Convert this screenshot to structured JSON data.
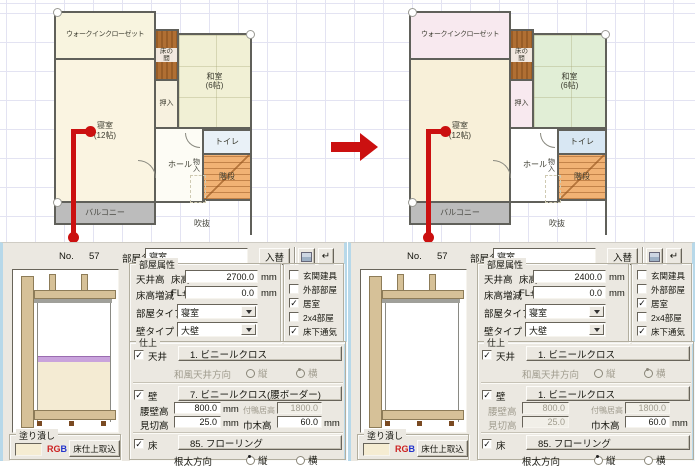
{
  "units": {
    "mm": "mm"
  },
  "icons": {
    "return": "↵"
  },
  "annotation": {
    "arrow_color": "#cb1010",
    "line_color": "#cb1010"
  },
  "plans": [
    {
      "rooms": {
        "walkin": "ウォークインクローゼット",
        "tokonoma": "床の間",
        "washitsu": "和室",
        "washitsu_size": "(6帖)",
        "oshiire": "押入",
        "bedroom": "寝室",
        "bedroom_size": "(12帖)",
        "toilet": "トイレ",
        "hall": "ホール",
        "monoire": "物入",
        "stairs": "階段",
        "balcony": "バルコニー",
        "void": "吹抜"
      },
      "room_colors": {
        "walkin": "#f8f4df",
        "tokonoma": "#b06f33",
        "washitsu": "#f1f0d5",
        "oshiire": "#f7f1df",
        "bedroom": "#faf4e1",
        "toilet": "#e9f1f7",
        "hall": "#fdfcf5",
        "stairs": "#f1b274",
        "balcony": "#bcbcbc"
      }
    },
    {
      "rooms": {
        "walkin": "ウォークインクローゼット",
        "tokonoma": "床の間",
        "washitsu": "和室",
        "washitsu_size": "(6帖)",
        "oshiire": "押入",
        "bedroom": "寝室",
        "bedroom_size": "(12帖)",
        "toilet": "トイレ",
        "hall": "ホール",
        "monoire": "物入",
        "stairs": "階段",
        "balcony": "バルコニー",
        "void": "吹抜"
      },
      "room_colors": {
        "walkin": "#f8e9ef",
        "tokonoma": "#b06f33",
        "washitsu": "#e1eed6",
        "oshiire": "#f8e9ef",
        "bedroom": "#f8f0d9",
        "toilet": "#d8e7f3",
        "hall": "#ffffff",
        "stairs": "#f1b274",
        "balcony": "#bcbcbc"
      }
    }
  ],
  "panels": [
    {
      "no_label": "No.",
      "no_value": "57",
      "room_name_label": "部屋名",
      "room_name_value": "寝室",
      "swap_button": "入替",
      "attr": {
        "title": "部屋属性",
        "ceiling_label": "天井高",
        "floor_plus_label": "床高+",
        "ceiling_value": "2700.0",
        "floor_adj_label": "床高増減",
        "fl_label": "FL±",
        "fl_value": "0.0",
        "room_type_label": "部屋タイプ",
        "room_type_value": "寝室",
        "wall_type_label": "壁タイプ",
        "wall_type_value": "大壁"
      },
      "checks": [
        {
          "label": "玄関建具",
          "mark": ""
        },
        {
          "label": "外部部屋",
          "mark": ""
        },
        {
          "label": "居室",
          "mark": "✓"
        },
        {
          "label": "2x4部屋",
          "mark": ""
        },
        {
          "label": "床下通気",
          "mark": "✓"
        }
      ],
      "finish": {
        "title": "仕上",
        "ceiling_label": "天井",
        "ceiling_mark": "✓",
        "ceiling_button": "1. ビニールクロス",
        "wafu_label": "和風天井方向",
        "tate": "縦",
        "yoko": "横",
        "wall_label": "壁",
        "wall_mark": "✓",
        "wall_button": "7. ビニールクロス(腰ボーダー)",
        "koshikabe_label": "腰壁高",
        "koshikabe_value": "800.0",
        "tsukekamoi_label": "付鴨居高",
        "tsukekamoi_value": "1800.0",
        "mikiri_label": "見切高",
        "mikiri_value": "25.0",
        "habaki_label": "巾木高",
        "habaki_value": "60.0",
        "floor_label": "床",
        "floor_mark": "✓",
        "floor_button": "85. フローリング",
        "neda_label": "根太方向"
      },
      "fill": {
        "title": "塗り潰し",
        "rgb_r": "R",
        "rgb_g": "G",
        "rgb_b": "B",
        "import_button": "床仕上取込",
        "swatch_color": "#f5ecd2"
      }
    },
    {
      "no_label": "No.",
      "no_value": "57",
      "room_name_label": "部屋名",
      "room_name_value": "寝室",
      "swap_button": "入替",
      "attr": {
        "title": "部屋属性",
        "ceiling_label": "天井高",
        "floor_plus_label": "床高+",
        "ceiling_value": "2400.0",
        "floor_adj_label": "床高増減",
        "fl_label": "FL±",
        "fl_value": "0.0",
        "room_type_label": "部屋タイプ",
        "room_type_value": "寝室",
        "wall_type_label": "壁タイプ",
        "wall_type_value": "大壁"
      },
      "checks": [
        {
          "label": "玄関建具",
          "mark": ""
        },
        {
          "label": "外部部屋",
          "mark": ""
        },
        {
          "label": "居室",
          "mark": "✓"
        },
        {
          "label": "2x4部屋",
          "mark": ""
        },
        {
          "label": "床下通気",
          "mark": "✓"
        }
      ],
      "finish": {
        "title": "仕上",
        "ceiling_label": "天井",
        "ceiling_mark": "✓",
        "ceiling_button": "1. ビニールクロス",
        "wafu_label": "和風天井方向",
        "tate": "縦",
        "yoko": "横",
        "wall_label": "壁",
        "wall_mark": "✓",
        "wall_button": "1. ビニールクロス",
        "koshikabe_label": "腰壁高",
        "koshikabe_value": "800.0",
        "tsukekamoi_label": "付鴨居高",
        "tsukekamoi_value": "1800.0",
        "mikiri_label": "見切高",
        "mikiri_value": "25.0",
        "habaki_label": "巾木高",
        "habaki_value": "60.0",
        "floor_label": "床",
        "floor_mark": "✓",
        "floor_button": "85. フローリング",
        "neda_label": "根太方向"
      },
      "fill": {
        "title": "塗り潰し",
        "rgb_r": "R",
        "rgb_g": "G",
        "rgb_b": "B",
        "import_button": "床仕上取込",
        "swatch_color": "#f5ecd2"
      }
    }
  ]
}
